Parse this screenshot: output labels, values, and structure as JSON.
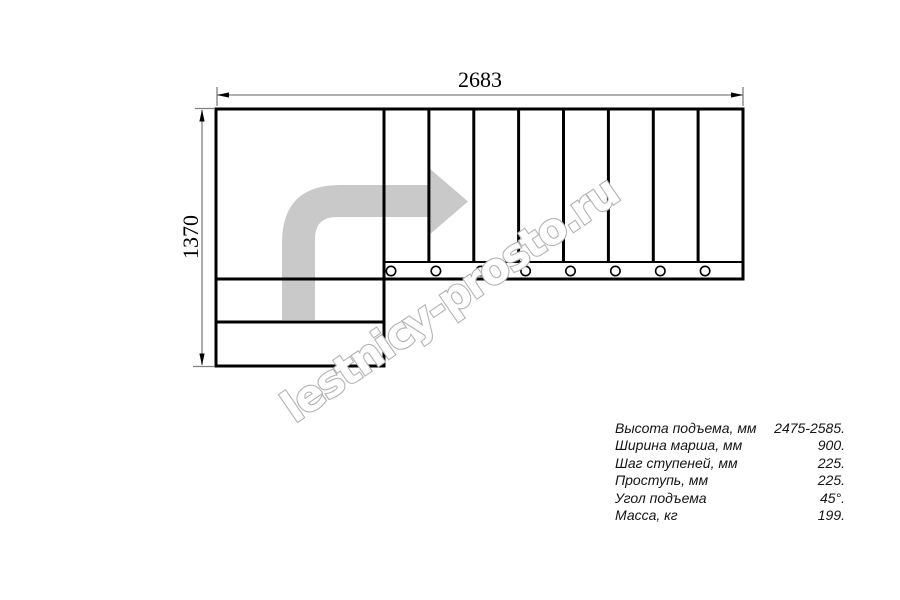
{
  "drawing": {
    "width_dimension": "2683",
    "height_dimension": "1370",
    "tread_count": 8,
    "watermark": "lestnicy-prosto.ru",
    "colors": {
      "plan_line": "#000000",
      "dimension_line": "#808080",
      "dimension_text": "#000000",
      "direction_arrow_fill": "#c9c9c9",
      "watermark_outline": "#b2b2b2",
      "watermark_fill": "#ffffff",
      "background": "#ffffff"
    }
  },
  "specs": {
    "rows": [
      {
        "label": "Высота подъема, мм",
        "value": "2475-2585."
      },
      {
        "label": "Ширина марша, мм",
        "value": "900."
      },
      {
        "label": "Шаг ступеней, мм",
        "value": "225."
      },
      {
        "label": "Проступь, мм",
        "value": "225."
      },
      {
        "label": "Угол подъема",
        "value": "45°."
      },
      {
        "label": "Масса, кг",
        "value": "199."
      }
    ]
  }
}
